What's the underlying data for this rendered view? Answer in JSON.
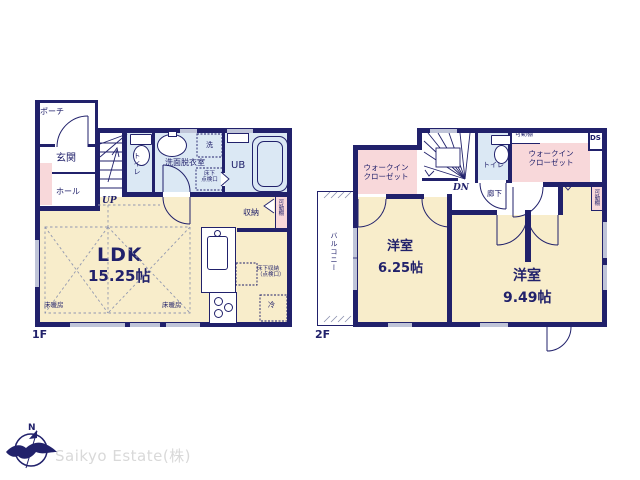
{
  "company": "Saikyo Estate(株)",
  "compass": {
    "north": "N"
  },
  "colors": {
    "wall_navy": "#21216b",
    "room_cream": "#f8edcb",
    "closet_pink": "#f8d8da",
    "wet_blue": "#dbe8f4",
    "window_gray": "#bfc4d8"
  },
  "f1": {
    "floor_label": "1F",
    "porch": "ポーチ",
    "entrance": "玄関",
    "hall": "ホール",
    "stairs_up": "UP",
    "toilet": "トイレ",
    "washroom": "洗面脱衣室",
    "washer": "洗",
    "hatch_line1": "床下",
    "hatch_line2": "点検口",
    "bath": "UB",
    "storage": "収納",
    "shelf": "可動棚",
    "ldk": "LDK",
    "ldk_size": "15.25帖",
    "floor_heating": "床暖房",
    "underfloor_line1": "床下収納",
    "underfloor_line2": "（点検口）",
    "fridge": "冷"
  },
  "f2": {
    "floor_label": "2F",
    "wic_line1": "ウォークイン",
    "wic_line2": "クローゼット",
    "stairs_down": "DN",
    "toilet": "トイレ",
    "shelf": "可動棚",
    "duct": "DS",
    "hallway": "廊下",
    "balcony": "バルコニー",
    "room1": "洋室",
    "room1_size": "6.25帖",
    "room2": "洋室",
    "room2_size": "9.49帖"
  }
}
